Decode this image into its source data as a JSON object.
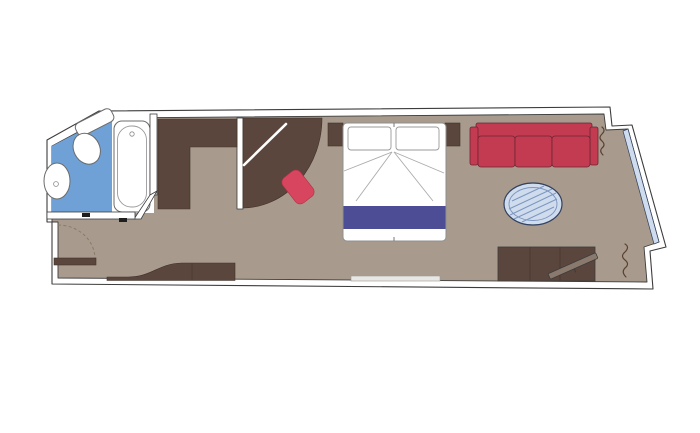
{
  "meta": {
    "type": "floor-plan",
    "subject": "cruise-cabin-with-angled-balcony-wall"
  },
  "colors": {
    "canvas_bg": "#ffffff",
    "wall_fill": "#ffffff",
    "wall_outline": "#3c3c3c",
    "floor": "#a89b8d",
    "dark_wood": "#5b463d",
    "dark_wood_edge": "#40322a",
    "sofa_red": "#c33b51",
    "sofa_edge": "#6b2534",
    "stool_red": "#d8455e",
    "stool_edge": "#b23048",
    "bed_white": "#ffffff",
    "bed_outline": "#8f8f8f",
    "linen_line": "#ababab",
    "bed_runner_navy": "#4d4d95",
    "bathroom_blue": "#70a1d6",
    "fixture_white": "#ffffff",
    "fixture_outline": "#6b6b6b",
    "glass_blue": "#cfdcee",
    "glass_outline": "#31415f",
    "table_hatch": "#7e96bf",
    "curtain_brown": "#5a4030",
    "tv_bar": "#8a7a6e",
    "threshold_light": "#e9e7e3",
    "door_mark_dark": "#1e1e1e",
    "door_arc": "#8a7a6a"
  },
  "elements": [
    "outer-wall",
    "cabin-floor",
    "balcony-window-glazing",
    "bathroom-floor",
    "bathtub",
    "sink",
    "toilet",
    "entrance-door",
    "door-swing-arc",
    "closet",
    "curved-wardrobe",
    "wardrobe-mirror",
    "stool",
    "nightstand-left",
    "nightstand-right",
    "double-bed",
    "pillows",
    "bed-runner",
    "sofa",
    "coffee-table",
    "tv-cabinet",
    "tv",
    "desk",
    "curtain-top-right",
    "curtain-bottom-right",
    "threshold"
  ]
}
